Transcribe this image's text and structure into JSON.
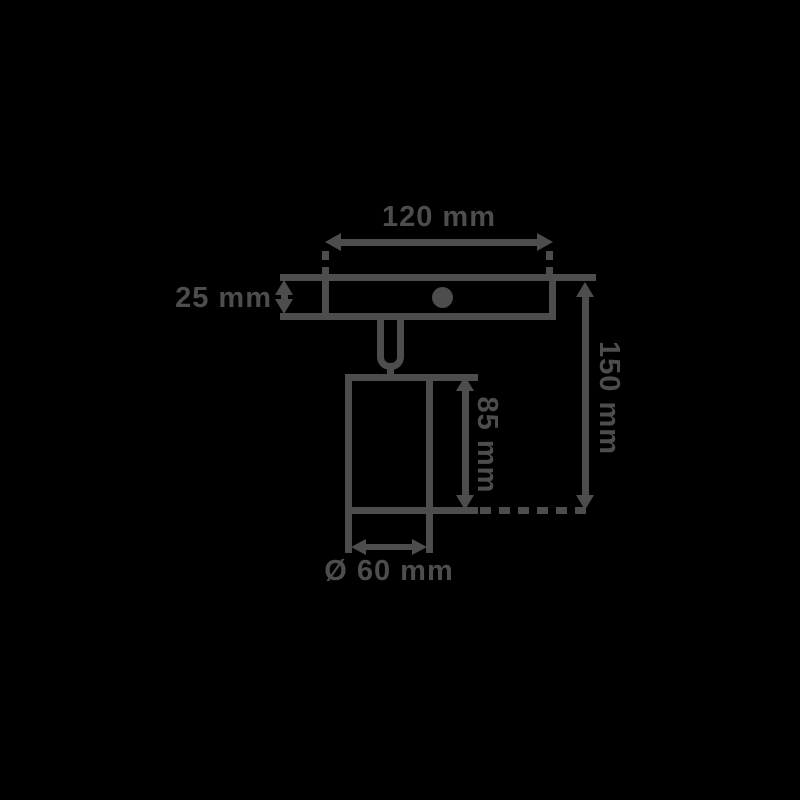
{
  "colors": {
    "background": "#000000",
    "line": "#4d4d4d"
  },
  "dimensions": {
    "width": "120 mm",
    "plate_height": "25 mm",
    "overall_height": "150 mm",
    "body_height": "85 mm",
    "diameter": "Ø 60 mm"
  }
}
